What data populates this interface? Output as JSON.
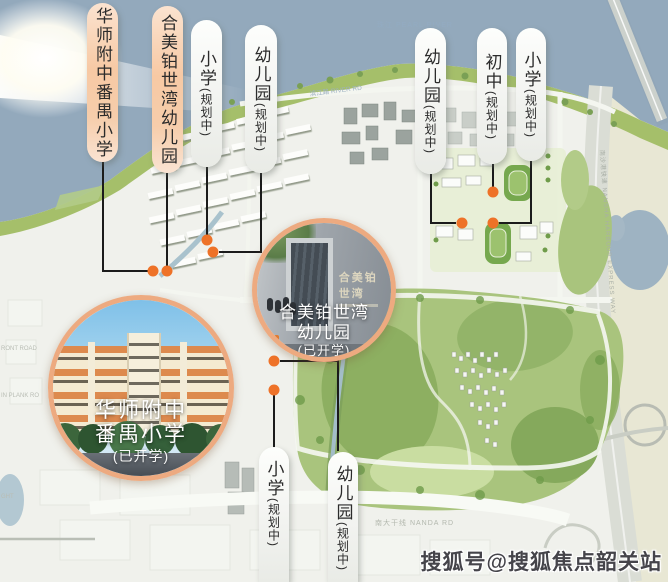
{
  "accent": {
    "dot_color": "#ee7228",
    "circle_border_color": "#edaa80",
    "peach_pill_color": "#f7c9a4",
    "leader_line_color": "#1b1b1b"
  },
  "pills": [
    {
      "name": "华师附中番禺小学",
      "style": "peach"
    },
    {
      "name": "合美铂世湾幼儿园",
      "style": "peach"
    },
    {
      "name": "小学",
      "status": "(规划中)",
      "style": "white"
    },
    {
      "name": "幼儿园",
      "status": "(规划中)",
      "style": "white"
    },
    {
      "name": "幼儿园",
      "status": "(规划中)",
      "style": "white"
    },
    {
      "name": "初中",
      "status": "(规划中)",
      "style": "white"
    },
    {
      "name": "小学",
      "status": "(规划中)",
      "style": "white"
    },
    {
      "name": "小学",
      "status": "(规划中)",
      "style": "white"
    },
    {
      "name": "幼儿园",
      "status": "(规划中)",
      "style": "white"
    }
  ],
  "photo_callouts": [
    {
      "line1": "合美铂世湾",
      "line2": "幼儿园",
      "status": "(已开学)",
      "sign_text": "合美铂世湾"
    },
    {
      "line1": "华师附中",
      "line2": "番禺小学",
      "status": "(已开学)"
    }
  ],
  "map_labels": {
    "pearl_river": "珠江 PEARL RIVER",
    "riverside_road": "滨江路 RIVER RD",
    "expressway": "南沙港快速 NANSHA HARBOUR EXPRESS WAY",
    "nanda_road": "南大干线 NANDA RD",
    "left_road_fragment_1": "RONT ROAD",
    "left_road_fragment_2": "IN PLANK RO",
    "left_road_fragment_3": "GHT"
  },
  "watermark": "搜狐号@搜狐焦点韶关站"
}
